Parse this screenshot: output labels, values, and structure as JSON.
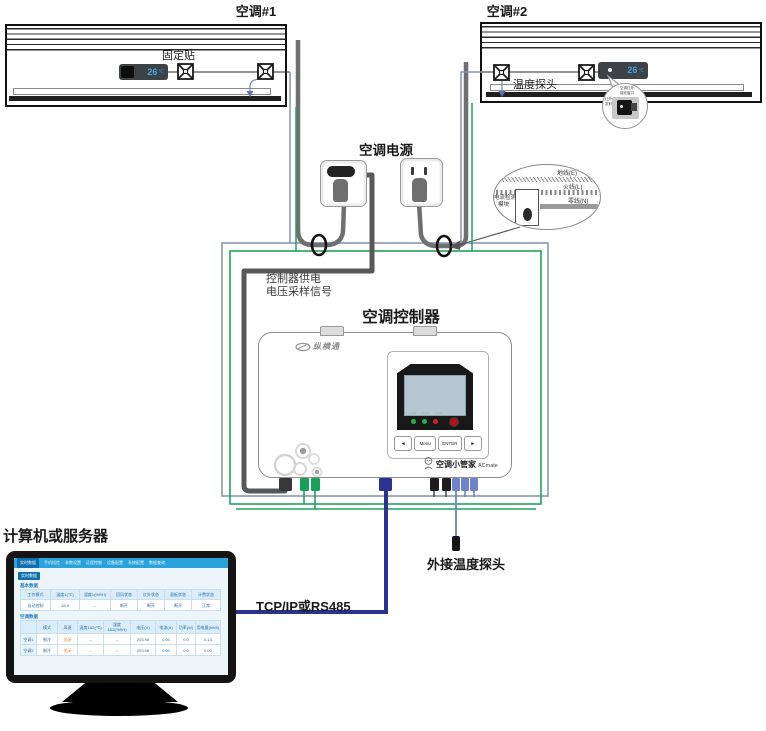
{
  "titles": {
    "ac1": "空调#1",
    "ac2": "空调#2",
    "power": "空调电源",
    "controller": "空调控制器",
    "computer": "计算机或服务器",
    "tcp": "TCP/IP或RS485",
    "ext_probe": "外接温度探头",
    "fixing_sticker": "固定贴",
    "temp_probe": "温度探头",
    "supply_line1": "控制器供电",
    "supply_line2": "电压采样信号"
  },
  "display": {
    "temp": "26",
    "unit": "℃"
  },
  "ir_callout": {
    "top1": "空调红外",
    "top2": "接收窗口",
    "left1": "红外",
    "left2": "发射头"
  },
  "power_callout": {
    "ground": "地线(E)",
    "live": "火线(L)",
    "neutral": "零线(N)",
    "module1": "电流检测",
    "module2": "模块"
  },
  "controller": {
    "brand": "纵横通",
    "led_labels": "PWR RUN ALM",
    "btn_left": "◄",
    "btn_menu": "Menu",
    "btn_enter": "ENTER",
    "btn_right": "►",
    "product": "空调小管家",
    "product_en": "ACmate"
  },
  "monitor": {
    "tabs": [
      "实时数据",
      "手机短信",
      "参数设置",
      "远程控制",
      "设备配置",
      "系统配置",
      "数据查询"
    ],
    "section": "实时数据",
    "basic_title": "基本数据",
    "basic_headers": [
      "工作模式",
      "温度1(℃)",
      "湿度1(%RH)",
      "回风状态",
      "红外状态",
      "面板状态",
      "计费状态"
    ],
    "basic_row": [
      "自动控制",
      "28.5",
      "--",
      "断开",
      "断开",
      "断开",
      "正常"
    ],
    "ac_title": "空调数据",
    "ac_headers": [
      "",
      "模式",
      "风速",
      "温度1&2(℃)",
      "湿度1&2(%RH)",
      "电压(V)",
      "电流(A)",
      "功率(W)",
      "用电量(kWh)"
    ],
    "ac_rows": [
      [
        "空调1",
        "制冷",
        "关闭",
        "--",
        "--",
        "203.98",
        "0.00",
        "0.0",
        "0.13"
      ],
      [
        "空调2",
        "制冷",
        "关闭",
        "--",
        "--",
        "203.98",
        "0.00",
        "0.0",
        "0.00"
      ]
    ]
  },
  "colors": {
    "wire_gray": "#6f6f6f",
    "frame_gray": "#8a98ac",
    "green": "#1ea35f",
    "navy": "#2b3390",
    "periwinkle": "#6e84c9",
    "display_blue": "#45a6ea",
    "bar_blue": "#2aa2da",
    "orange": "#e2882b",
    "table_blue": "#2d6da8"
  }
}
